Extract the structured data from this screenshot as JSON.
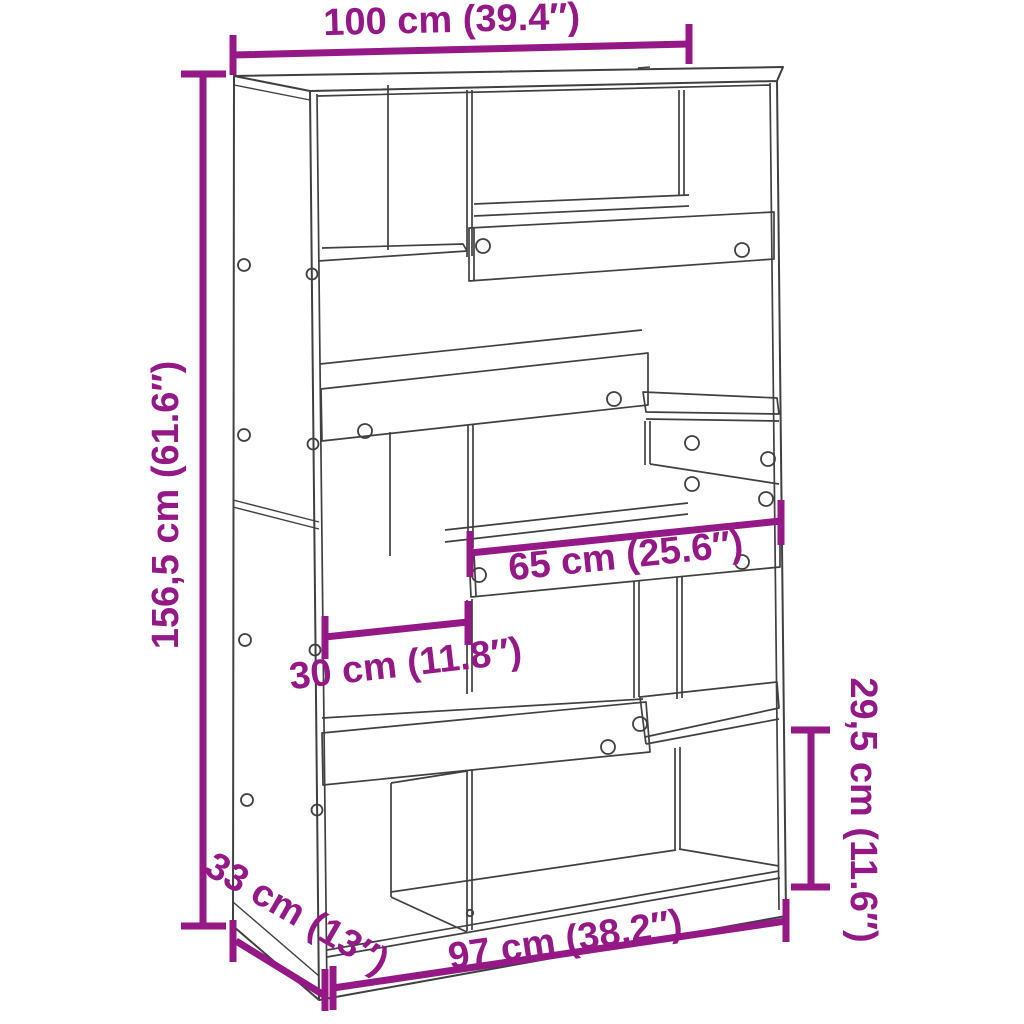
{
  "diagram": {
    "accent_color": "#941885",
    "line_color": "#404040",
    "background_color": "#ffffff",
    "dimensions": {
      "top_width": "100 cm (39.4″)",
      "height": "156,5 cm (61.6″)",
      "shelf_width": "65 cm (25.6″)",
      "compartment_width": "30 cm (11.8″)",
      "compartment_height": "29,5 cm (11.6″)",
      "depth": "33 cm (13″)",
      "bottom_width": "97 cm (38.2″)"
    }
  }
}
